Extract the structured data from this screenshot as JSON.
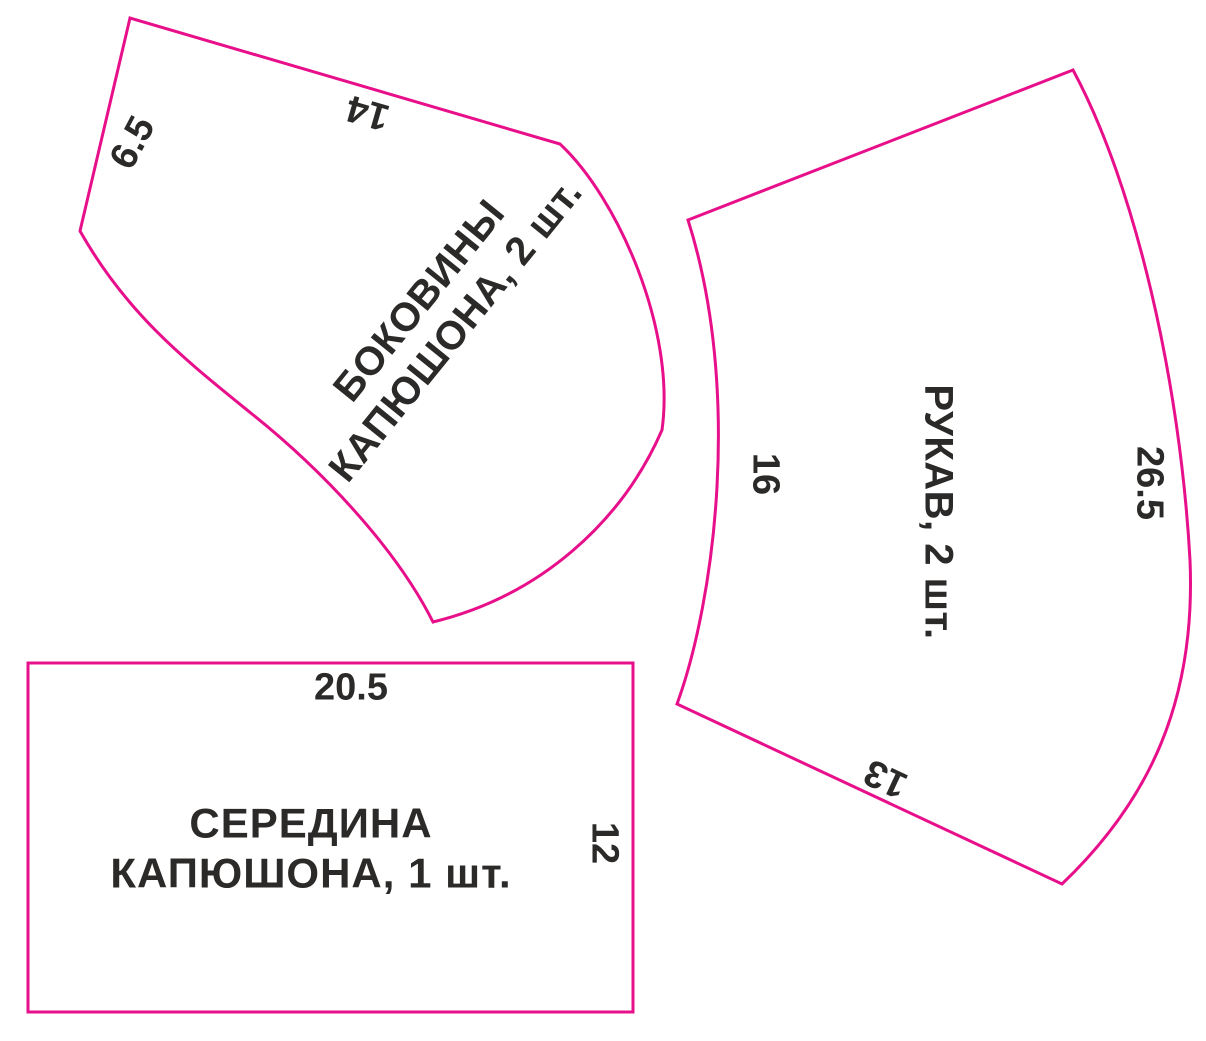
{
  "colors": {
    "outline": "#e80f8b",
    "ink": "#2b2a29",
    "background": "#ffffff"
  },
  "pieces": {
    "hood_side": {
      "name_line1": "БОКОВИНЫ",
      "name_line2": "КАПЮШОНА, 2 шт.",
      "dim_left": "6.5",
      "dim_top": "14"
    },
    "sleeve": {
      "name": "РУКАВ, 2 шт.",
      "dim_left": "16",
      "dim_right": "26.5",
      "dim_bottom": "13"
    },
    "hood_center": {
      "name_line1": "СЕРЕДИНА",
      "name_line2": "КАПЮШОНА, 1 шт.",
      "dim_top": "20.5",
      "dim_right": "12"
    }
  }
}
